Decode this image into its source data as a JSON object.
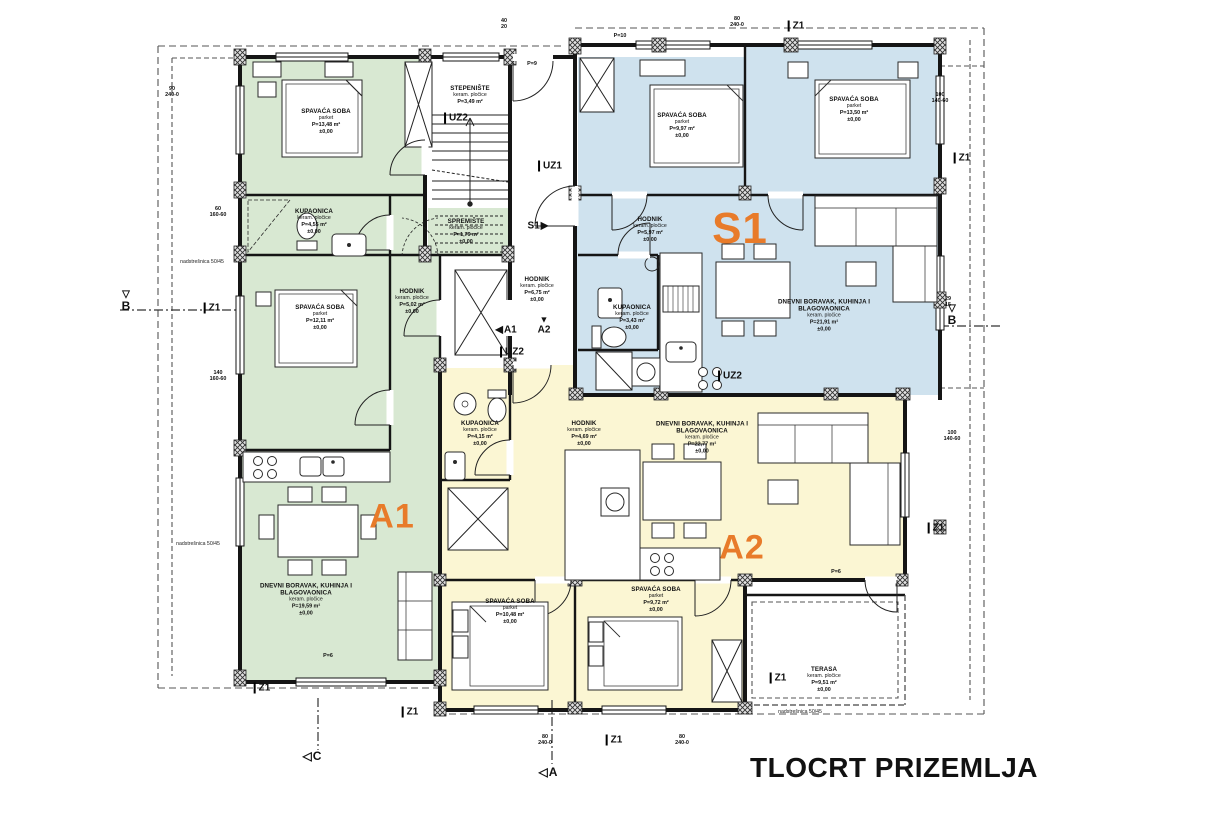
{
  "title": {
    "text": "TLOCRT PRIZEMLJA"
  },
  "palette": {
    "a1_green": "#d8e8d2",
    "s1_blue": "#cfe2ee",
    "a2_yellow": "#fbf6d3",
    "accent_orange": "#e87b2a",
    "line": "#151515"
  },
  "units": [
    {
      "id": "A1",
      "x": 392,
      "y": 517,
      "size": 34
    },
    {
      "id": "S1",
      "x": 740,
      "y": 229,
      "size": 44
    },
    {
      "id": "A2",
      "x": 742,
      "y": 548,
      "size": 34
    }
  ],
  "rooms": [
    {
      "name": "SPAVAĆA SOBA",
      "floor": "parket",
      "area": "P=13,48 m²",
      "level": "±0,00",
      "x": 326,
      "y": 122
    },
    {
      "name": "KUPAONICA",
      "floor": "keram. pločice",
      "area": "P=4,55 m²",
      "level": "±0,00",
      "x": 314,
      "y": 222
    },
    {
      "name": "SPAVAĆA SOBA",
      "floor": "parket",
      "area": "P=12,11 m²",
      "level": "±0,00",
      "x": 320,
      "y": 318
    },
    {
      "name": "HODNIK",
      "floor": "keram. pločice",
      "area": "P=5,02 m²",
      "level": "±0,00",
      "x": 412,
      "y": 302
    },
    {
      "name": "SPREMIŠTE",
      "floor": "keram. pločice",
      "area": "P=1,79 m²",
      "level": "±0,00",
      "x": 466,
      "y": 232
    },
    {
      "name": "DNEVNI BORAVAK, KUHINJA I BLAGOVAONICA",
      "floor": "keram. pločice",
      "area": "P=19,59 m²",
      "level": "±0,00",
      "x": 306,
      "y": 600,
      "w": 130
    },
    {
      "name": "STEPENIŠTE",
      "floor": "keram. pločice",
      "area": "P=3,49 m²",
      "level": "",
      "x": 470,
      "y": 96
    },
    {
      "name": "HODNIK",
      "floor": "keram. pločice",
      "area": "P=6,75 m²",
      "level": "±0,00",
      "x": 537,
      "y": 290
    },
    {
      "name": "SPAVAĆA SOBA",
      "floor": "parket",
      "area": "P=9,97 m²",
      "level": "±0,00",
      "x": 682,
      "y": 126
    },
    {
      "name": "SPAVAĆA SOBA",
      "floor": "parket",
      "area": "P=13,50 m²",
      "level": "±0,00",
      "x": 854,
      "y": 110
    },
    {
      "name": "HODNIK",
      "floor": "keram. pločice",
      "area": "P=5,97 m²",
      "level": "±0,00",
      "x": 650,
      "y": 230
    },
    {
      "name": "KUPAONICA",
      "floor": "keram. pločice",
      "area": "P=3,43 m²",
      "level": "±0,00",
      "x": 632,
      "y": 318
    },
    {
      "name": "DNEVNI BORAVAK, KUHINJA I BLAGOVAONICA",
      "floor": "keram. pločice",
      "area": "P=21,91 m²",
      "level": "±0,00",
      "x": 824,
      "y": 316,
      "w": 140
    },
    {
      "name": "KUPAONICA",
      "floor": "keram. pločice",
      "area": "P=4,15 m²",
      "level": "±0,00",
      "x": 480,
      "y": 434
    },
    {
      "name": "HODNIK",
      "floor": "keram. pločice",
      "area": "P=4,69 m²",
      "level": "±0,00",
      "x": 584,
      "y": 434
    },
    {
      "name": "DNEVNI BORAVAK, KUHINJA I BLAGOVAONICA",
      "floor": "keram. pločice",
      "area": "P=22,77 m²",
      "level": "±0,00",
      "x": 702,
      "y": 438,
      "w": 140
    },
    {
      "name": "SPAVAĆA SOBA",
      "floor": "parket",
      "area": "P=10,48 m²",
      "level": "±0,00",
      "x": 510,
      "y": 612
    },
    {
      "name": "SPAVAĆA SOBA",
      "floor": "parket",
      "area": "P=9,72 m²",
      "level": "±0,00",
      "x": 656,
      "y": 600
    },
    {
      "name": "TERASA",
      "floor": "keram. pločice",
      "area": "P=9,51 m²",
      "level": "±0,00",
      "x": 824,
      "y": 680
    }
  ],
  "markers": [
    {
      "text": "B",
      "glyph": "▽",
      "kind": "sec",
      "x": 126,
      "y": 302
    },
    {
      "text": "B",
      "glyph": "▽",
      "kind": "sec",
      "x": 952,
      "y": 316
    },
    {
      "text": "C",
      "glyph": "◁",
      "kind": "secline",
      "x": 312,
      "y": 756
    },
    {
      "text": "A",
      "glyph": "◁",
      "kind": "secline",
      "x": 548,
      "y": 772
    },
    {
      "text": "Z1",
      "glyph": "",
      "kind": "flag",
      "x": 212,
      "y": 308
    },
    {
      "text": "Z1",
      "glyph": "",
      "kind": "flag",
      "x": 796,
      "y": 26
    },
    {
      "text": "Z1",
      "glyph": "",
      "kind": "flag",
      "x": 962,
      "y": 158
    },
    {
      "text": "Z1",
      "glyph": "",
      "kind": "flag",
      "x": 936,
      "y": 528
    },
    {
      "text": "Z1",
      "glyph": "",
      "kind": "flag",
      "x": 778,
      "y": 678
    },
    {
      "text": "Z1",
      "glyph": "",
      "kind": "flag",
      "x": 262,
      "y": 688
    },
    {
      "text": "Z1",
      "glyph": "",
      "kind": "flag",
      "x": 410,
      "y": 712
    },
    {
      "text": "Z1",
      "glyph": "",
      "kind": "flag",
      "x": 614,
      "y": 740
    },
    {
      "text": "UZ2",
      "glyph": "",
      "kind": "flag",
      "x": 456,
      "y": 118
    },
    {
      "text": "UZ1",
      "glyph": "",
      "kind": "flag",
      "x": 550,
      "y": 166
    },
    {
      "text": "UZ2",
      "glyph": "",
      "kind": "flag",
      "x": 512,
      "y": 352
    },
    {
      "text": "UZ2",
      "glyph": "",
      "kind": "flag",
      "x": 730,
      "y": 376
    },
    {
      "text": "S1",
      "glyph": "▶",
      "kind": "dir-right",
      "x": 538,
      "y": 226
    },
    {
      "text": "A1",
      "glyph": "◀",
      "kind": "dir-left",
      "x": 506,
      "y": 330
    },
    {
      "text": "A2",
      "glyph": "▼",
      "kind": "dir-down",
      "x": 544,
      "y": 326
    }
  ],
  "dim_tags": [
    {
      "l1": "60",
      "l2": "160-60",
      "x": 218,
      "y": 212
    },
    {
      "l1": "140",
      "l2": "160-60",
      "x": 218,
      "y": 376
    },
    {
      "l1": "90",
      "l2": "240-0",
      "x": 172,
      "y": 92
    },
    {
      "l1": "40",
      "l2": "20",
      "x": 504,
      "y": 24
    },
    {
      "l1": "80",
      "l2": "240-0",
      "x": 737,
      "y": 22
    },
    {
      "l1": "100",
      "l2": "140-60",
      "x": 940,
      "y": 98
    },
    {
      "l1": "29",
      "l2": "15",
      "x": 948,
      "y": 302
    },
    {
      "l1": "100",
      "l2": "140-60",
      "x": 952,
      "y": 436
    },
    {
      "l1": "80",
      "l2": "240-0",
      "x": 545,
      "y": 740
    },
    {
      "l1": "80",
      "l2": "240-0",
      "x": 682,
      "y": 740
    },
    {
      "l1": "P=9",
      "l2": "",
      "x": 532,
      "y": 64
    },
    {
      "l1": "P=10",
      "l2": "",
      "x": 620,
      "y": 36
    },
    {
      "l1": "P=6",
      "l2": "",
      "x": 328,
      "y": 656
    },
    {
      "l1": "P=6",
      "l2": "",
      "x": 836,
      "y": 572
    }
  ],
  "notes": [
    {
      "text": "nadstrešnica 50/45",
      "x": 202,
      "y": 262
    },
    {
      "text": "nadstrešnica 50/45",
      "x": 198,
      "y": 544
    },
    {
      "text": "nadstrešnica 50/45",
      "x": 800,
      "y": 712
    }
  ]
}
